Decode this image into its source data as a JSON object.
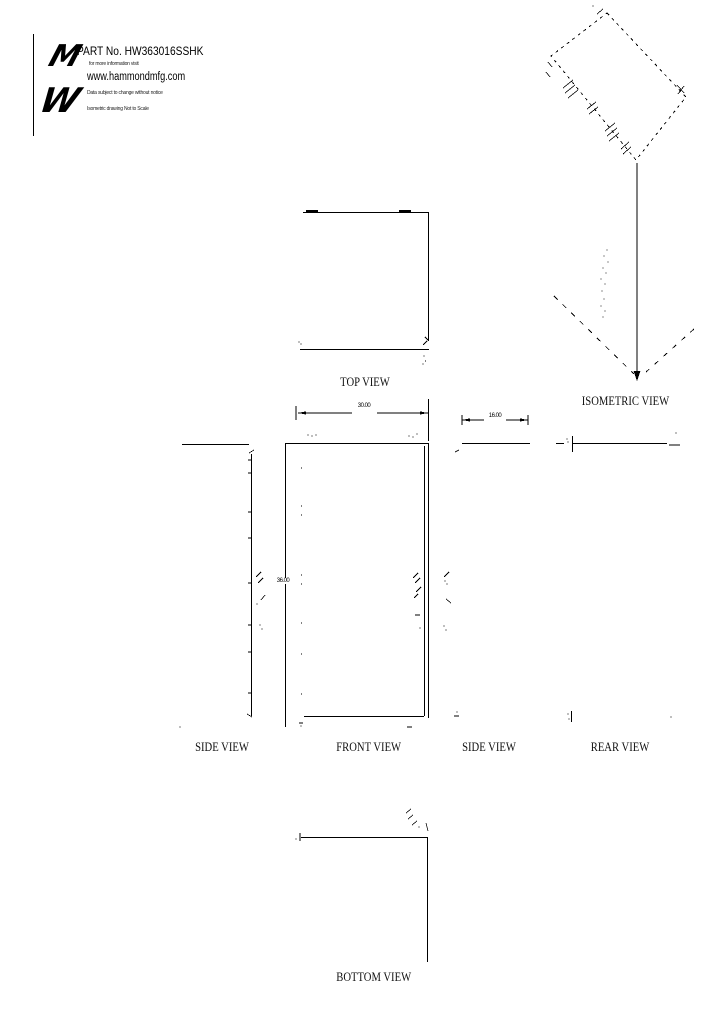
{
  "title_block": {
    "logo_top": "M",
    "logo_bottom": "W",
    "part_line": "PART No. HW363016SSHK",
    "info_line": "for more information visit",
    "website": "www.hammondmfg.com",
    "disclaimer": "Data subject to change without notice",
    "scale_note": "Isometric drawing Not to Scale"
  },
  "labels": {
    "top_view": "TOP VIEW",
    "isometric_view": "ISOMETRIC VIEW",
    "side_view_left": "SIDE VIEW",
    "front_view": "FRONT VIEW",
    "side_view_right": "SIDE VIEW",
    "rear_view": "REAR VIEW",
    "bottom_view": "BOTTOM VIEW"
  },
  "dimensions": {
    "front_width": "30.00",
    "front_height": "36.00",
    "side_depth": "16.00"
  },
  "colors": {
    "line": "#000000",
    "background": "#ffffff"
  }
}
